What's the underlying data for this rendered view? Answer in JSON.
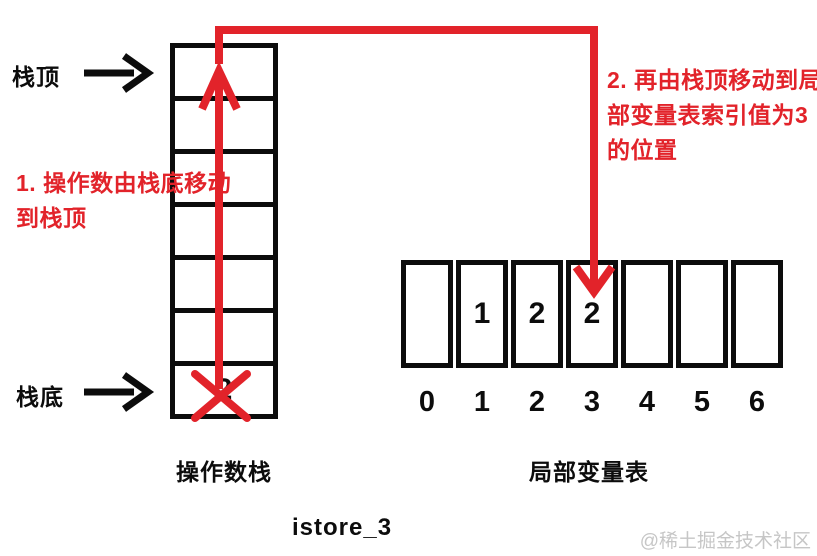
{
  "colors": {
    "accent_red": "#e2232a",
    "line_black": "#0c0c0c",
    "watermark_gray": "#c6c6c6"
  },
  "labels": {
    "stack_top": "栈顶",
    "stack_bottom": "栈底",
    "operand_stack": "操作数栈",
    "local_variable_table": "局部变量表",
    "title": "istore_3",
    "watermark": "@稀土掘金技术社区"
  },
  "annotations": {
    "step1": {
      "line1": "1. 操作数由栈底移动",
      "line2": "到栈顶"
    },
    "step2": {
      "line1": "2. 再由栈顶移动到局",
      "line2": "部变量表索引值为3",
      "line3": "的位置"
    }
  },
  "operand_stack": {
    "rows": 7,
    "bottom_value": "2",
    "bottom_value_state": "crossed-out"
  },
  "local_variable_table": {
    "indices": [
      "0",
      "1",
      "2",
      "3",
      "4",
      "5",
      "6"
    ],
    "values": [
      "",
      "1",
      "2",
      "2",
      "",
      "",
      ""
    ],
    "arrow_target_index": "3"
  }
}
